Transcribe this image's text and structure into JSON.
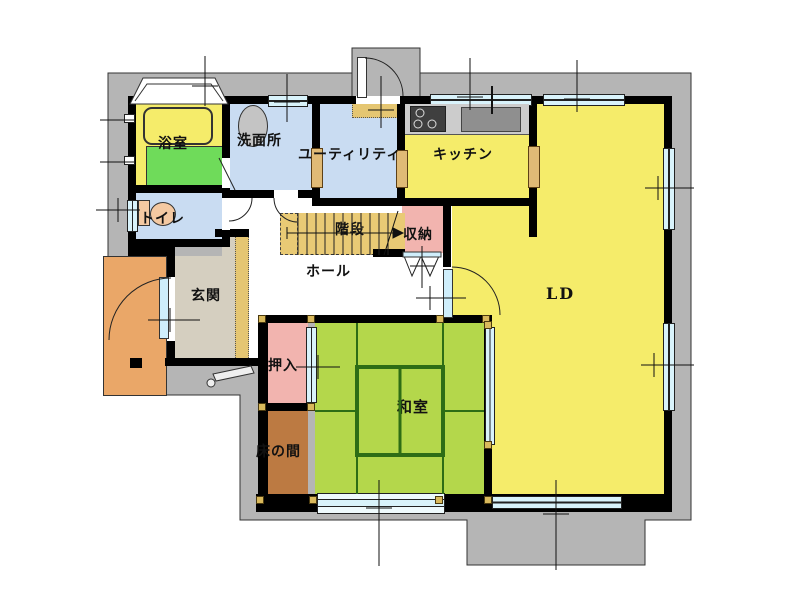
{
  "plan": {
    "type": "residential-floor-plan",
    "wall_color": "#000000",
    "site_color": "#b5b5b5",
    "window_glass_color": "#d9f3fb",
    "post_color": "#d9b95c"
  },
  "rooms": [
    {
      "id": "bathroom",
      "label": "浴室",
      "floor_color": "#6fdb5a"
    },
    {
      "id": "washroom",
      "label": "洗面所",
      "floor_color": "#c9dcf2"
    },
    {
      "id": "utility",
      "label": "ユーティリティ",
      "floor_color": "#c9dcf2"
    },
    {
      "id": "kitchen",
      "label": "キッチン",
      "floor_color": "#f5ec6a"
    },
    {
      "id": "toilet",
      "label": "トイレ",
      "floor_color": "#c9dcf2"
    },
    {
      "id": "stairs",
      "label": "階段",
      "floor_color": "#e9ca75"
    },
    {
      "id": "storage",
      "label": "収納",
      "floor_color": "#f2b4af"
    },
    {
      "id": "hall",
      "label": "ホール",
      "floor_color": "#ffffff"
    },
    {
      "id": "entrance",
      "label": "玄関",
      "floor_color": "#d5cfc0"
    },
    {
      "id": "living-dining",
      "label": "LD",
      "floor_color": "#f5ec6a"
    },
    {
      "id": "closet",
      "label": "押入",
      "floor_color": "#f2b4af"
    },
    {
      "id": "japanese-room",
      "label": "和室",
      "floor_color": "#b4d74b"
    },
    {
      "id": "tokonoma",
      "label": "床の間",
      "floor_color": "#bc7a42"
    }
  ],
  "fixtures": [
    "bathtub",
    "wash-basin",
    "toilet-bowl",
    "gas-stove",
    "kitchen-sink",
    "staircase-arrow",
    "entrance-porch",
    "bay-window",
    "entrance-step-stone"
  ]
}
